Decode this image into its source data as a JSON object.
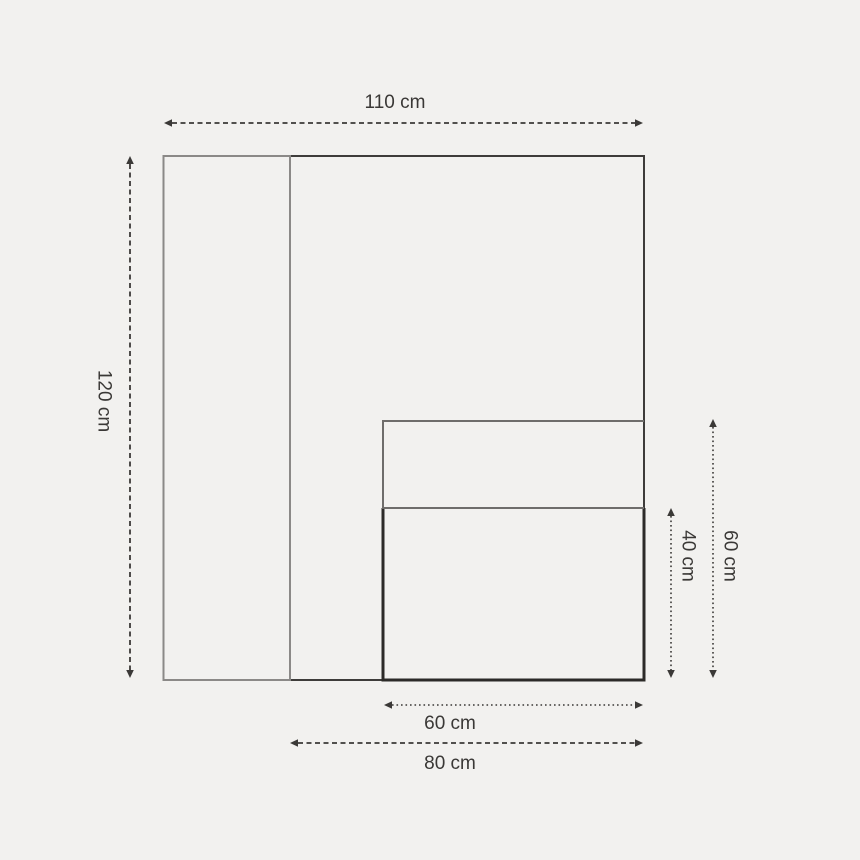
{
  "canvas": {
    "width": 860,
    "height": 860,
    "background": "#f2f1ef"
  },
  "palette": {
    "outline_dark": "#3e3c3a",
    "outline_gray": "#8b8987",
    "outline_medium": "#6f6d6b",
    "outline_heavy": "#2c2a28",
    "dimension_color": "#3b3937",
    "label_color": "#3a3836"
  },
  "shapes": [
    {
      "id": "cabinet-outline",
      "type": "rect",
      "x": 290,
      "y": 156,
      "w": 354,
      "h": 524,
      "stroke": "outline_dark",
      "stroke_width": 2
    },
    {
      "id": "left-panel",
      "type": "rect",
      "x": 163.5,
      "y": 156,
      "w": 126.5,
      "h": 524,
      "stroke": "outline_gray",
      "stroke_width": 2
    },
    {
      "id": "lower-compartment",
      "type": "path",
      "d": "M 383 508 L 383 680 L 644 680 L 644 508",
      "stroke": "outline_heavy",
      "stroke_width": 3
    },
    {
      "id": "upper-compartment",
      "type": "path",
      "d": "M 644 421 L 383 421 L 383 508 L 644 508",
      "stroke": "outline_medium",
      "stroke_width": 2
    }
  ],
  "dimensions": [
    {
      "id": "total-width",
      "label": "110 cm",
      "value_cm": 110,
      "style": "dashed",
      "axis": "h",
      "pos": 123,
      "from": 164,
      "to": 643,
      "label_x": 395,
      "label_y": 108,
      "rotated": false
    },
    {
      "id": "total-height",
      "label": "120 cm",
      "value_cm": 120,
      "style": "dashed",
      "axis": "v",
      "pos": 130,
      "from": 156,
      "to": 678,
      "label_x": 104,
      "label_y": 401,
      "rotated": true
    },
    {
      "id": "lower-height",
      "label": "40 cm",
      "value_cm": 40,
      "style": "dotted",
      "axis": "v",
      "pos": 671,
      "from": 508,
      "to": 678,
      "label_x": 688,
      "label_y": 556,
      "rotated": true
    },
    {
      "id": "inner-height",
      "label": "60 cm",
      "value_cm": 60,
      "style": "dotted",
      "axis": "v",
      "pos": 713,
      "from": 419,
      "to": 678,
      "label_x": 730,
      "label_y": 556,
      "rotated": true
    },
    {
      "id": "inner-width",
      "label": "60 cm",
      "value_cm": 60,
      "style": "dotted",
      "axis": "h",
      "pos": 705,
      "from": 384,
      "to": 643,
      "label_x": 450,
      "label_y": 729,
      "rotated": false
    },
    {
      "id": "lower-width",
      "label": "80 cm",
      "value_cm": 80,
      "style": "dashed",
      "axis": "h",
      "pos": 743,
      "from": 290,
      "to": 643,
      "label_x": 450,
      "label_y": 769,
      "rotated": false
    }
  ],
  "dimension_styles": {
    "dashed": {
      "dasharray": "5 3.5",
      "stroke_width": 1.8
    },
    "dotted": {
      "dasharray": "1.6 2.9",
      "stroke_width": 1.6
    }
  },
  "font": {
    "size_px": 19
  }
}
